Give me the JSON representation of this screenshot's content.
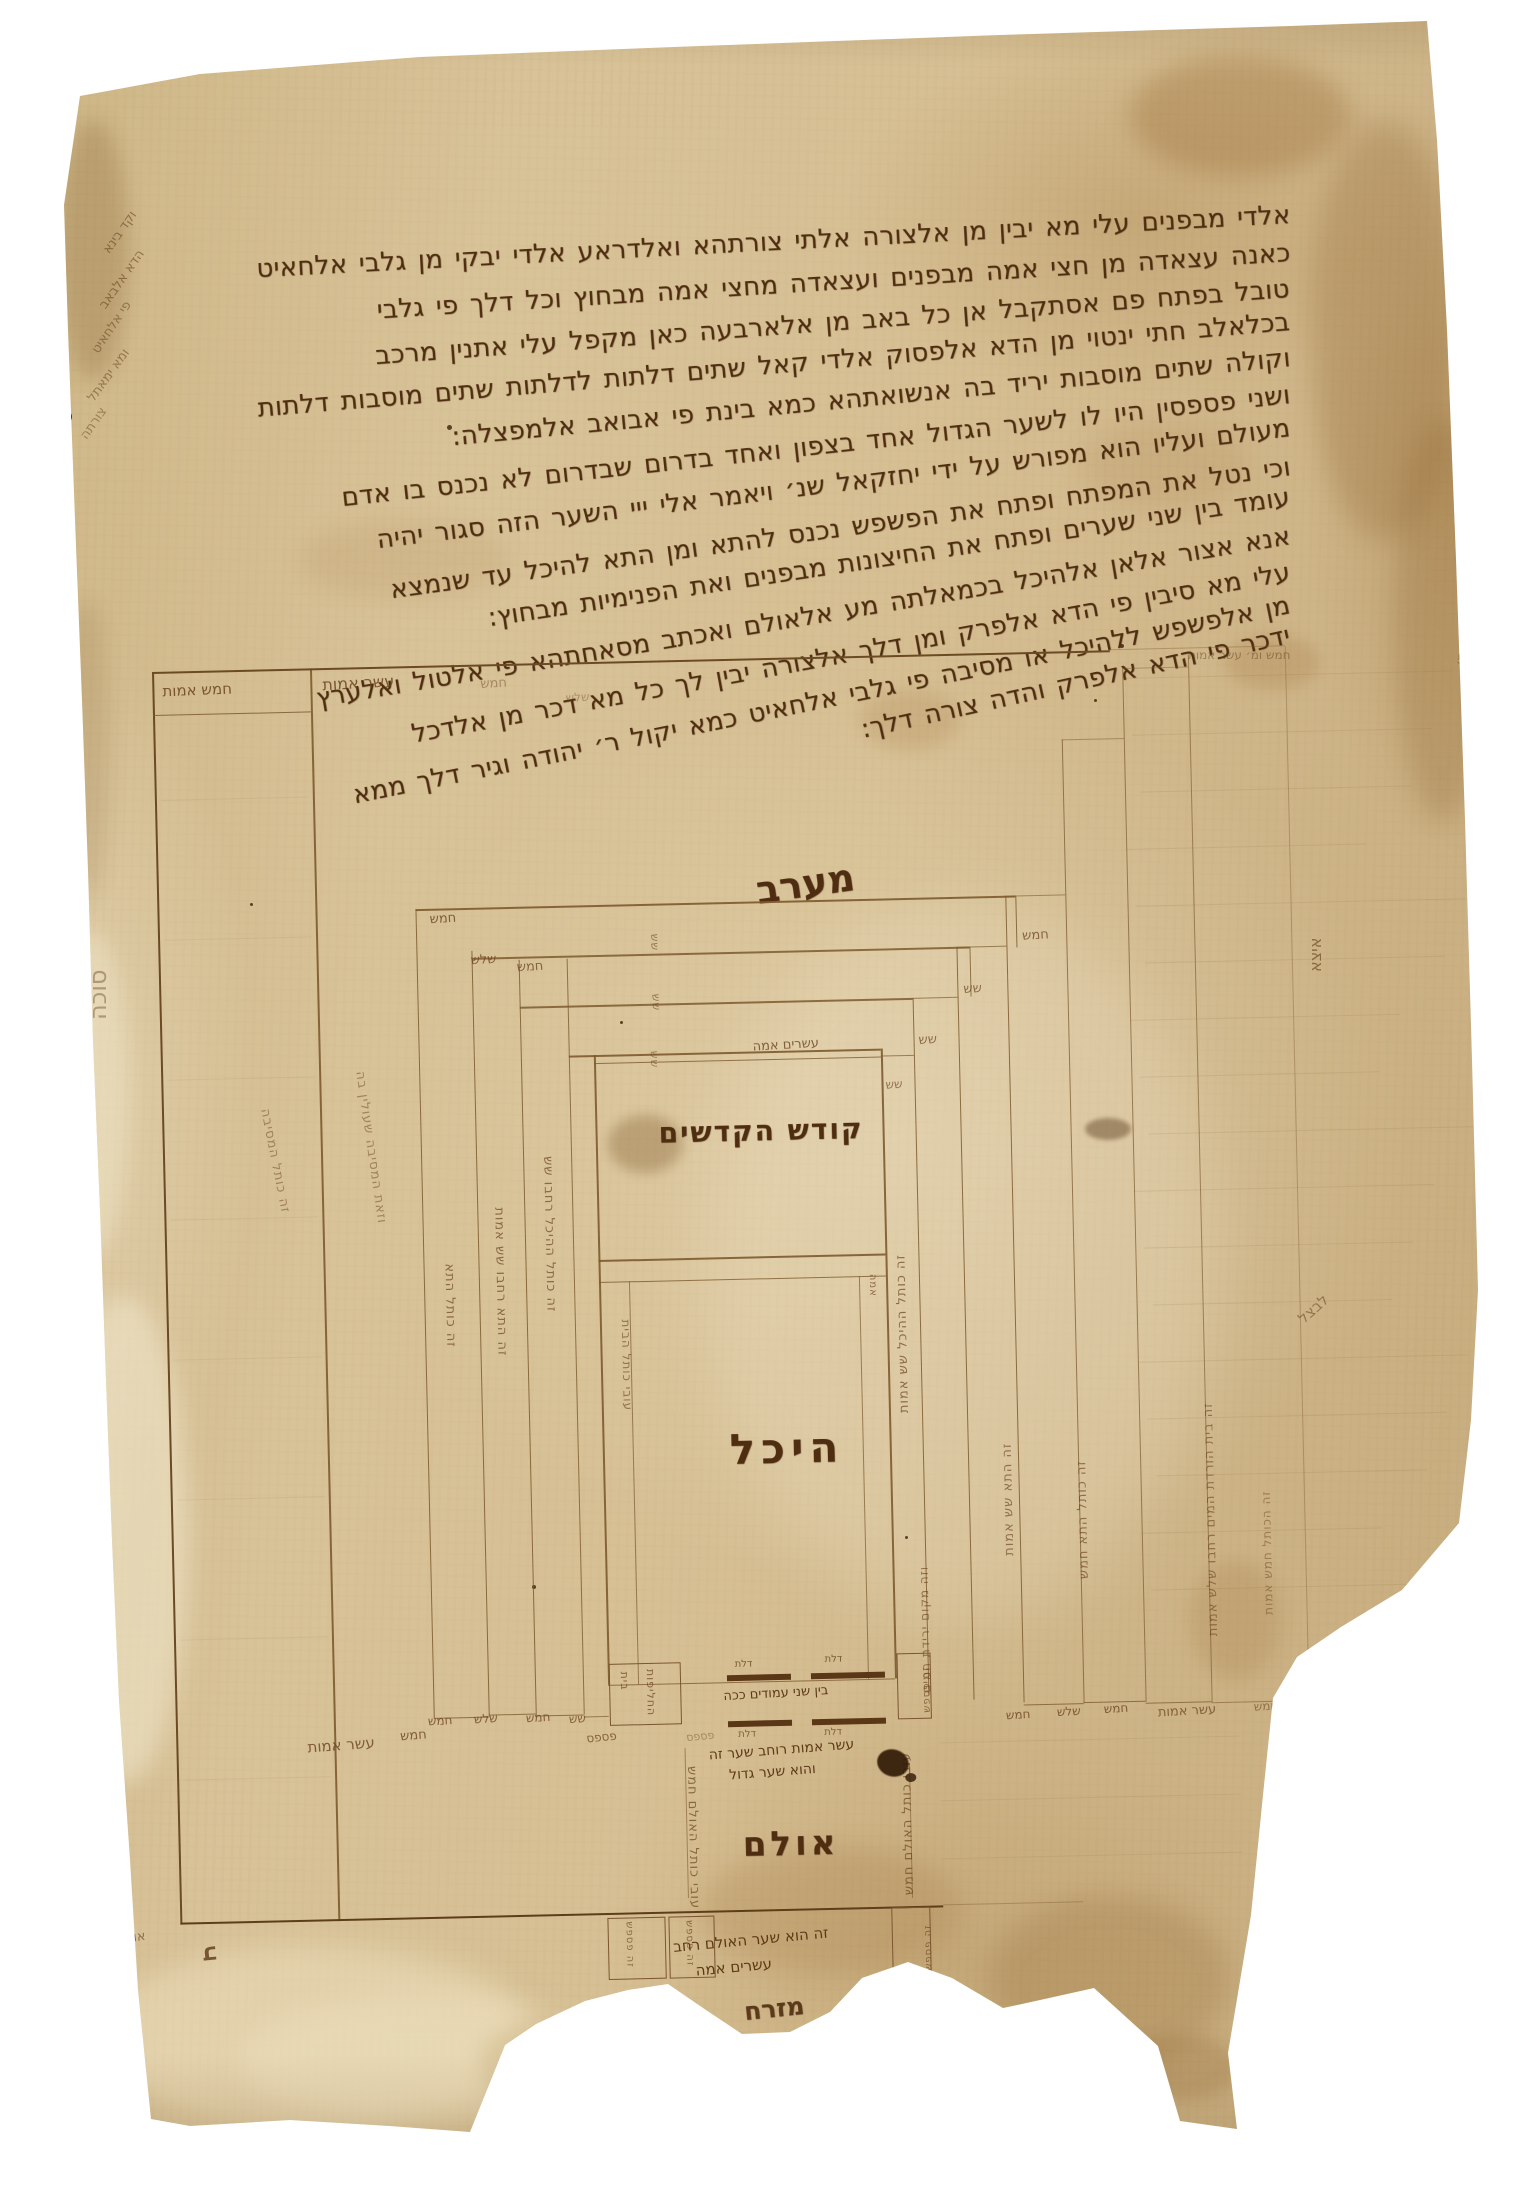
{
  "text": {
    "lines": [
      "אלדי מבפנים עלי מא יבין מן אלצורה אלתי צורתהא ואלדראע אלדי יבקי מן גלבי אלחאיט",
      "כאנה עצאדה מן חצי אמה מבפנים ועצאדה מחצי אמה מבחוץ וכל דלך פי גלבי",
      "טובל בפתח פם אסתקבל אן כל באב מן אלארבעה כאן מקפל עלי אתנין מרכב",
      "בכלאלב חתי ינטוי מן הדא אלפסוק אלדי קאל שתים דלתות לדלתות שתים מוסבות דלתות",
      "וקולה שתים מוסבות יריד בה אנשואתהא כמא בינת פי אבואב אלמפצלה:",
      "ושני פספסין היו לו לשער הגדול אחד בצפון ואחד בדרום שבדרום לא נכנס בו אדם",
      "מעולם ועליו הוא מפורש על ידי יחזקאל שנ׳ ויאמר אלי ייי השער הזה סגור יהיה",
      "וכי נטל את המפתח ופתח את הפשפש נכנס להתא ומן התא להיכל עד שנמצא",
      "עומד בין שני שערים ופתח את החיצונות מבפנים ואת הפנימיות מבחוץ:",
      "אנא אצור אלאן אלהיכל בכמאלתה מע אלאולם ואכתב מסאחתהא פי אלטול ואלערץ",
      "עלי מא סיבין פי הדא אלפרק ומן דלך אלצורה יבין לך כל מא דכר מן אלדכל",
      "מן אלפשפש ללהיכל או מסיבה פי גלבי אלחאיט כמא יקול ר׳ יהודה וגיר דלך ממא",
      "ידכר פי הדא אלפרק והדה צורה דלך:"
    ]
  },
  "compass": {
    "west": "מערב",
    "east": "מזרח"
  },
  "rooms": {
    "holy_of_holies": "קודש הקדשים",
    "heichal": "היכל",
    "ulam": "אולם"
  },
  "measures": {
    "five": "חמש",
    "three": "שלש",
    "six": "שש",
    "ten_amot": "עשר אמות",
    "five_amot": "חמש אמות",
    "twenty_amah": "עשרים אמה",
    "amah": "אמה",
    "pispas": "פספס"
  },
  "bands": {
    "left": [
      "זה כותל המסיבה",
      "וזאת המסיבה שעולין בה",
      "זה כותל התא",
      "זה התא רחבו שש אמות",
      "זה כותל ההיכל רחבו שש"
    ],
    "left_inner": "עובי כותל הבית",
    "right": [
      "זה כותל ההיכל שש אמות",
      "זה התא שש אמות",
      "זה כותל התא חמש",
      "זה בית הורדת המים רחבו שלש אמות",
      "זה הכותל חמש אמות"
    ],
    "right_dense": "וזה מקום ירידת המים",
    "ulam_side": "עובי כותל האולם חמש"
  },
  "gate": {
    "door": "דלת",
    "pillars": "בין שני עמודים ככה",
    "width_note_1": "עשר אמות רוחב שער זה",
    "width_note_2": "והוא שער גדול",
    "chaliphot_1": "בית",
    "chaliphot_2": "החליפות",
    "pispesh": "זה פספש",
    "ulam_note_1": "זה הוא שער האולם רחב",
    "ulam_note_2": "עשרים אמה"
  },
  "margin": {
    "left_gloss": [
      "וקד בינא",
      "הדא אלבאב",
      "פי אלחאיט",
      "ומא ימאתל",
      "צורתה"
    ],
    "left_column": "סוכה",
    "right_vertical": "איצא",
    "right_diagonal": "לבצל",
    "bottom_left": "אור",
    "curl": "ב",
    "top_right_faint": "חמש ומ׳ עשר אמות",
    "right_edge_tiny": "מ׳"
  }
}
